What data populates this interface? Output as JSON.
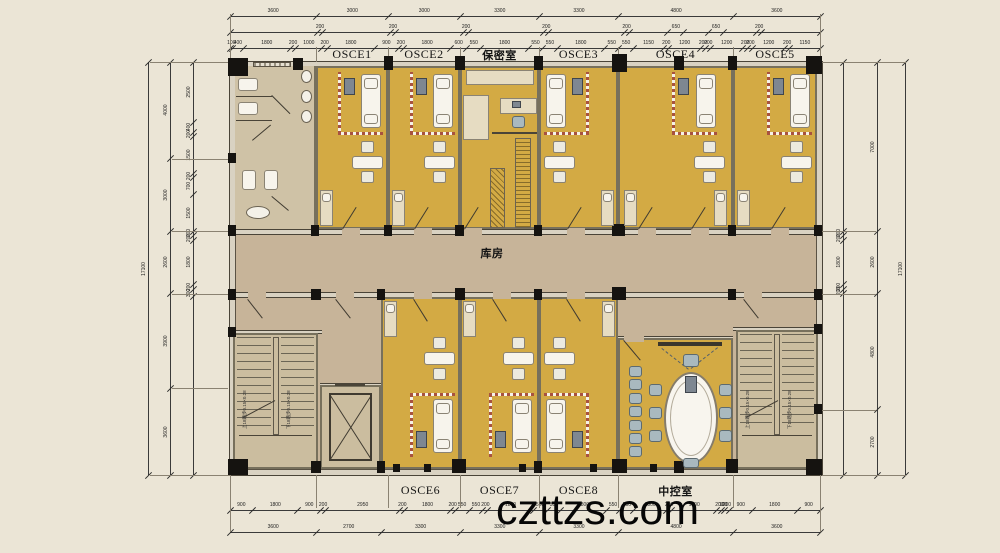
{
  "watermark": "czttzs.com",
  "colors": {
    "background": "#ebe5d6",
    "room_fill": "#d3aa44",
    "corridor_fill": "#c7b499",
    "service_fill": "#cbbd9f",
    "wall_fill": "#d9d2c2",
    "column_fill": "#151310"
  },
  "rooms": {
    "top": [
      "OSCE1",
      "OSCE2",
      "保密室",
      "OSCE3",
      "OSCE4",
      "OSCE5"
    ],
    "bottom": [
      "OSCE6",
      "OSCE7",
      "OSCE8",
      "中控室"
    ],
    "corridor": "库房"
  },
  "stairs": {
    "up": "上18踏步0.15×0.28",
    "down": "下18踏步0.15×0.28"
  },
  "dimensions": {
    "top_major": [
      3600,
      3000,
      3000,
      3300,
      3300,
      4800,
      3600
    ],
    "top_mid": [
      -3600,
      200,
      -2800,
      200,
      -2800,
      200,
      -3100,
      200,
      -3100,
      200,
      -1600,
      650,
      -1000,
      650,
      -1350,
      200,
      -2400
    ],
    "top_detail": [
      100,
      400,
      1800,
      200,
      1000,
      200,
      1800,
      900,
      200,
      1800,
      600,
      550,
      1800,
      550,
      550,
      1800,
      550,
      550,
      1150,
      200,
      1200,
      200,
      200,
      1200,
      200,
      200,
      1200,
      200,
      1150
    ],
    "bottom_detail": [
      900,
      1800,
      900,
      200,
      2950,
      200,
      1800,
      200,
      550,
      550,
      200,
      1800,
      550,
      550,
      1800,
      550,
      550,
      1300,
      200,
      1800,
      200,
      100,
      200,
      900,
      1800,
      900
    ],
    "bottom_major": [
      3600,
      2700,
      3300,
      3300,
      3300,
      4800,
      3600
    ],
    "left_total": [
      17100
    ],
    "left_major": [
      4000,
      3000,
      2600,
      3900,
      3600
    ],
    "left_detail": [
      2500,
      400,
      200,
      1500,
      200,
      700,
      1500,
      200,
      200,
      1800,
      200,
      300,
      -7400
    ],
    "right_detail": [
      -7000,
      200,
      200,
      1800,
      200,
      200,
      -7500
    ],
    "right_major": [
      7000,
      2600,
      4800,
      2700
    ],
    "right_total": [
      17100
    ]
  }
}
